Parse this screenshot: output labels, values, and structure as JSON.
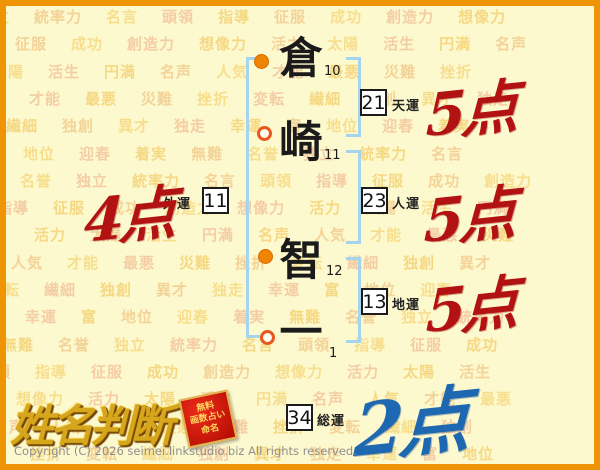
{
  "page": {
    "copyright": "Copyright (C) 2026 seimei.linkstudio.biz All rights reserved."
  },
  "logo": {
    "title": "姓名判断",
    "badge": {
      "line1": "無料",
      "line2": "画数占い",
      "line3": "命名"
    }
  },
  "name": {
    "characters": [
      {
        "char": "倉",
        "strokes": "10",
        "marker": "filled"
      },
      {
        "char": "崎",
        "strokes": "11",
        "marker": "open"
      },
      {
        "char": "智",
        "strokes": "12",
        "marker": "filled"
      },
      {
        "char": "一",
        "strokes": "1",
        "marker": "open"
      }
    ]
  },
  "fortunes": {
    "tenun": {
      "value": "21",
      "label": "天運",
      "score": "5点"
    },
    "gaiun": {
      "value": "11",
      "label": "外運",
      "score": "4点"
    },
    "jinun": {
      "value": "23",
      "label": "人運",
      "score": "5点"
    },
    "chiun": {
      "value": "13",
      "label": "地運",
      "score": "5点"
    },
    "souun": {
      "value": "34",
      "label": "総運",
      "score": "2点"
    }
  },
  "colors": {
    "score_red": "#b31212",
    "score_blue": "#1e68b2",
    "border_orange": "#ef9405",
    "bracket_blue": "#a5d5ee",
    "page_background": "#fdf9cf",
    "watermark_palette": [
      "#f5d57b",
      "#f2cf92",
      "#f7dc86",
      "#f4c9a0"
    ]
  },
  "background_words": [
    "独立",
    "統率力",
    "名言",
    "頭領",
    "指導",
    "征服",
    "成功",
    "創造力",
    "想像力",
    "活力",
    "太陽",
    "活生",
    "円満",
    "名声",
    "人気",
    "才能",
    "最悪",
    "災難",
    "挫折",
    "変転",
    "繊細",
    "独創",
    "異才",
    "独走",
    "幸運",
    "富",
    "地位",
    "迎春",
    "着実",
    "無難",
    "名誉"
  ]
}
